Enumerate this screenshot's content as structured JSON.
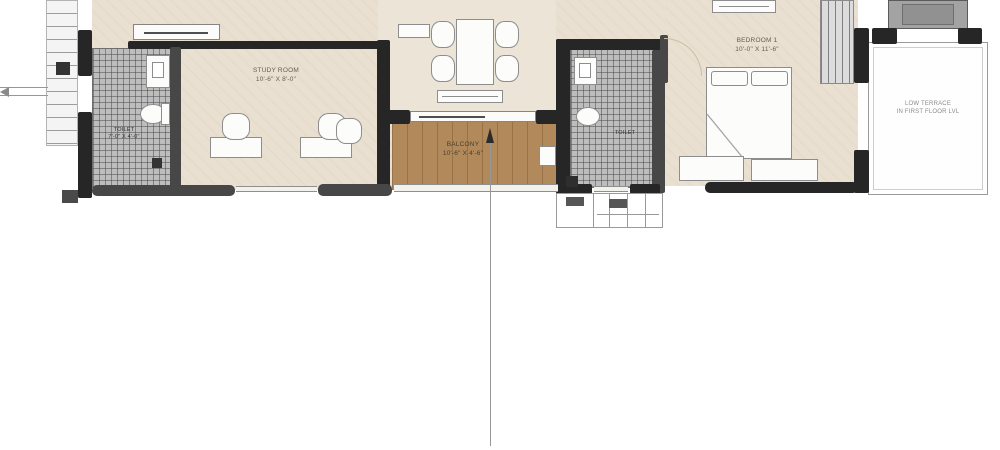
{
  "plan_title": "apartment-floor-plan-crop",
  "rooms": {
    "study": {
      "label": "STUDY ROOM",
      "dims": "10'-6\" X 8'-0\""
    },
    "bedroom": {
      "label": "BEDROOM 1",
      "dims": "10'-0\" X 11'-6\""
    },
    "balcony": {
      "label": "BALCONY",
      "dims": "10'-6\" X 4'-6\""
    },
    "terrace": {
      "line1": "LOW TERRACE",
      "line2": "IN FIRST FLOOR LVL"
    },
    "toilet_left": {
      "label": "TOILET",
      "dims": "7'-0\" X 4'-0\""
    },
    "toilet_right": {
      "label": "TOILET"
    }
  },
  "top_cut": {
    "left": "12'-0\" X 9'-0\"",
    "center": "10'-6\" X 9'-0\""
  },
  "colors": {
    "wall": "#262626",
    "floor": "#e9e0d1",
    "balcony_floor": "#b2895a",
    "tile_hatch": "#bdbdbd",
    "background": "#ffffff"
  }
}
